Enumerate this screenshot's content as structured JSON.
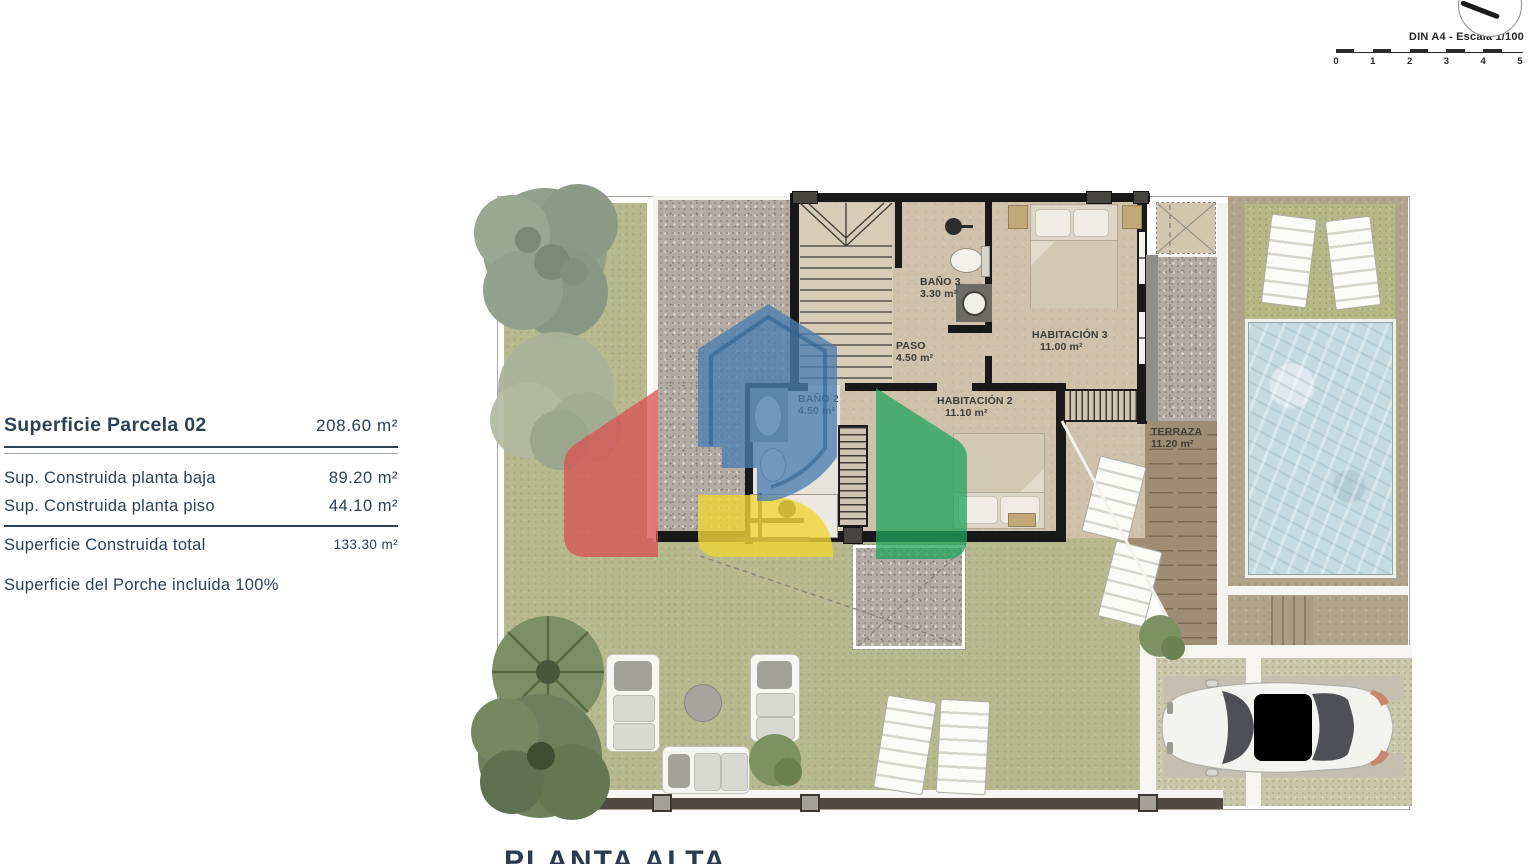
{
  "page": {
    "plan_title": "PLANTA ALTA"
  },
  "summary": {
    "title": {
      "label": "Superficie Parcela 02",
      "value": "208.60 m²"
    },
    "rows": [
      {
        "label": "Sup. Construida planta baja",
        "value": "89.20 m²"
      },
      {
        "label": "Sup. Construida planta piso",
        "value": "44.10 m²"
      }
    ],
    "total": {
      "label": "Superficie Construida total",
      "value": "133.30 m²"
    },
    "note": "Superficie del Porche incluida 100%",
    "text_color": "#2d4156"
  },
  "scale": {
    "label": "DIN A4 - Escala 1/100",
    "ticks": [
      "0",
      "1",
      "2",
      "3",
      "4",
      "5"
    ]
  },
  "plan": {
    "rooms": [
      {
        "name": "BAÑO 3",
        "area": "3.30 m²"
      },
      {
        "name": "PASO",
        "area": "4.50 m²"
      },
      {
        "name": "HABITACIÓN 3",
        "area": "11.00 m²"
      },
      {
        "name": "BAÑO 2",
        "area": "4.50 m²"
      },
      {
        "name": "HABITACIÓN 2",
        "area": "11.10 m²"
      },
      {
        "name": "TERRAZA",
        "area": "11.20 m²"
      }
    ]
  },
  "logo_colors": {
    "blue": "#4b7eb2",
    "red": "#d95353",
    "green": "#20a35c",
    "yellow": "#efd636"
  }
}
